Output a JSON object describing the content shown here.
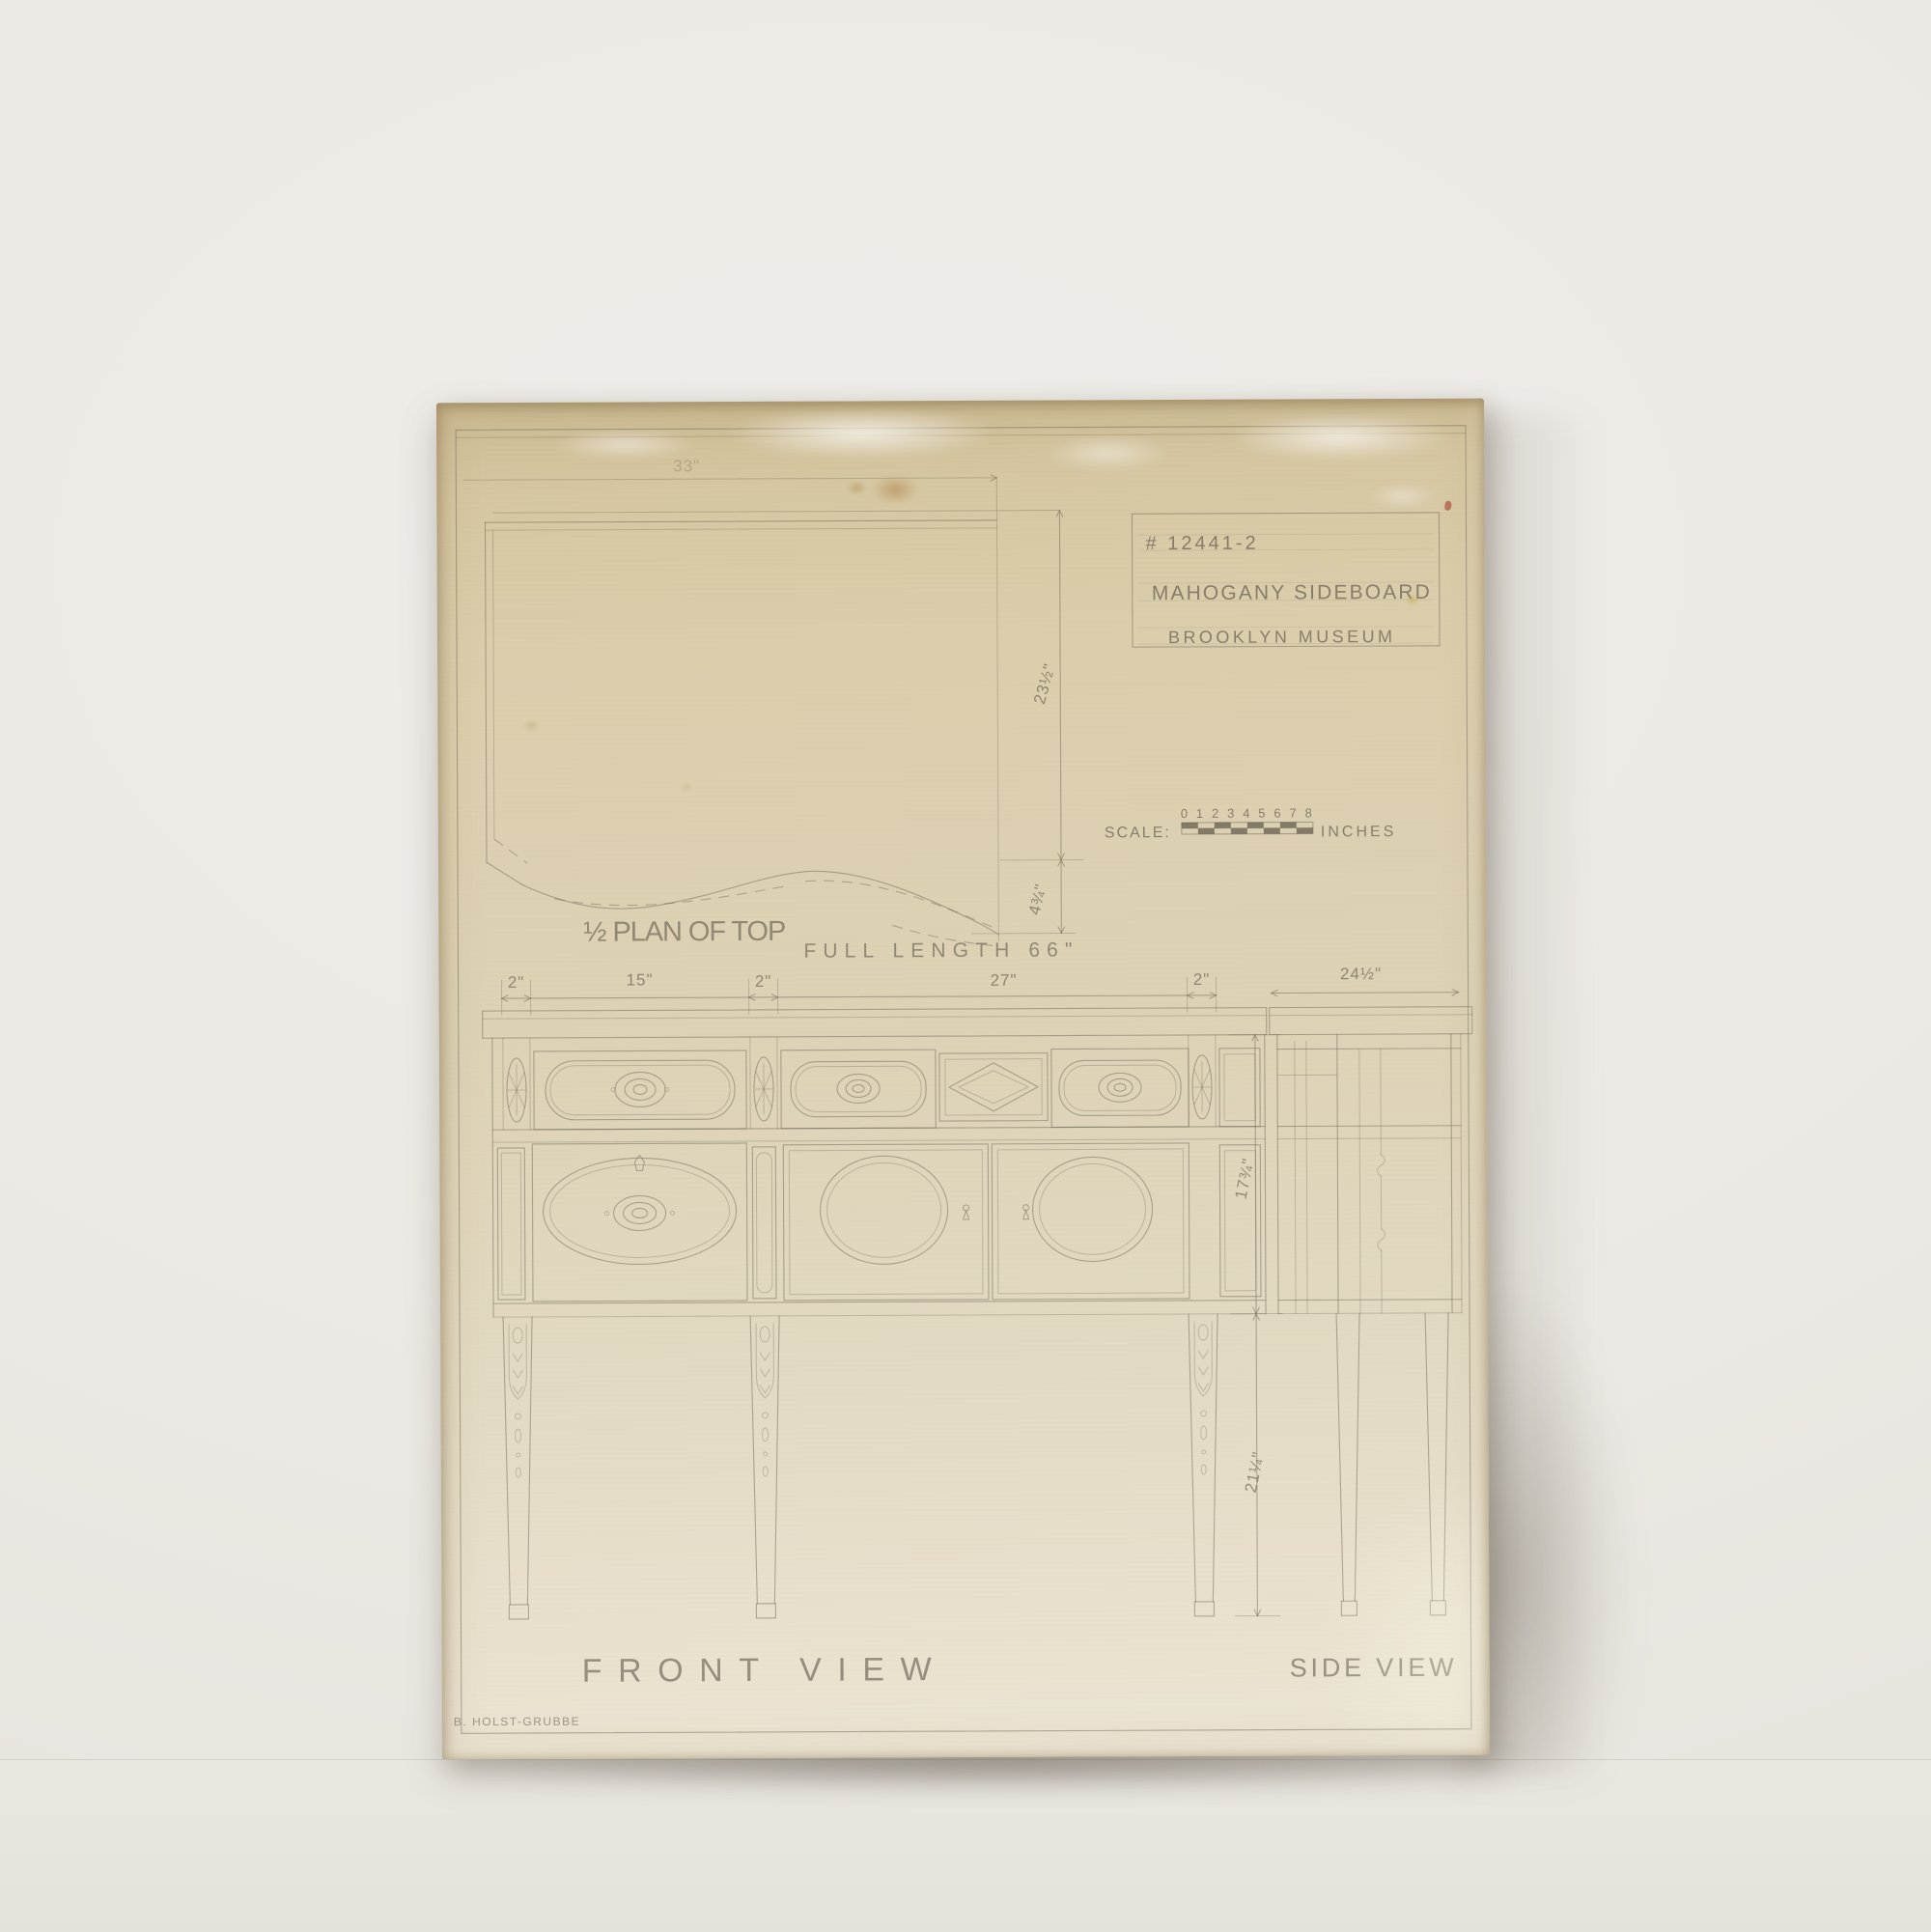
{
  "title_block": {
    "item_number": "# 12441-2",
    "line1": "MAHOGANY SIDEBOARD",
    "line2": "BROOKLYN MUSEUM"
  },
  "scale_bar": {
    "label": "SCALE:",
    "ticks": "0 1 2 3 4 5 6 7 8",
    "unit": "INCHES"
  },
  "plan_of_top": {
    "label": "½ PLAN OF TOP",
    "full_length": "FULL LENGTH 66\"",
    "half_length": "33\"",
    "depth": "23½\"",
    "swell": "4¾\""
  },
  "front_view": {
    "label": "FRONT VIEW",
    "width_dims": [
      "2\"",
      "15\"",
      "2\"",
      "27\"",
      "2\""
    ],
    "case_height": "17¾\"",
    "leg_height": "21¼\""
  },
  "side_view": {
    "label": "SIDE VIEW",
    "depth": "24½\""
  },
  "signature": "B. HOLST-GRUBBE",
  "colors": {
    "paper": "#d9cca9",
    "paper_dark": "#ccba92",
    "pencil": "#6e6857",
    "wall": "#ece9e4",
    "floor": "#e8e5df",
    "red_mark": "#a84a32"
  }
}
